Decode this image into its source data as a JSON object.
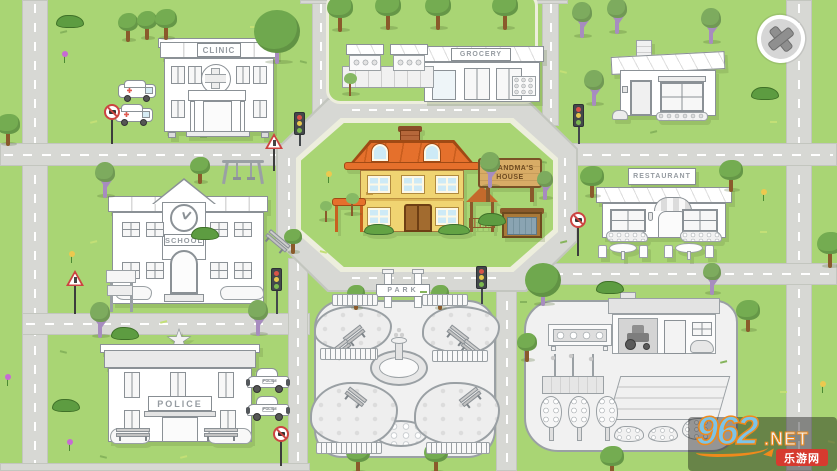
{
  "labels": {
    "clinic": "CLINIC",
    "grocery": "GROCERY",
    "school": "SCHOOL",
    "police": "POLICE",
    "park": "PARK",
    "restaurant": "RESTAURANT",
    "grandma1": "GRANDMA'S",
    "grandma2": "HOUSE",
    "police_car_text": "POLICE"
  },
  "watermark": {
    "site": "962",
    "net": ".NET",
    "cn": "乐游网"
  },
  "palette": {
    "grass": "#a9d574",
    "road": "#d7d8d4",
    "sidewalk": "#edeedd",
    "outline_gray": "#8b9196",
    "roof_orange": "#e5702c",
    "wall_yellow": "#f0d472",
    "door_brown": "#a26b2f",
    "window_blue": "#cdeaf6",
    "wood_sign": "#d8ac66",
    "tree_green": "#74ac51",
    "trunk_brown": "#8a5a2b",
    "trunk_purple": "#a78cbf",
    "sign_red": "#cc4441",
    "traffic_red": "#d85348",
    "traffic_yellow": "#e6c64d",
    "traffic_green": "#7cb94f",
    "wm_blue": "#7cc4e8",
    "wm_orange": "#ef8a1c",
    "wm_red": "#d63a2f"
  },
  "decorations": {
    "trees": [
      {
        "x": 128,
        "y": 42,
        "v": "g",
        "s": 0.8
      },
      {
        "x": 147,
        "y": 40,
        "v": "g",
        "s": 0.8
      },
      {
        "x": 166,
        "y": 40,
        "v": "g",
        "s": 0.85
      },
      {
        "x": 277,
        "y": 64,
        "v": "gp",
        "s": 1.5
      },
      {
        "x": 8,
        "y": 146,
        "v": "g",
        "s": 0.9
      },
      {
        "x": 340,
        "y": 32,
        "v": "g",
        "s": 1.0
      },
      {
        "x": 388,
        "y": 30,
        "v": "g",
        "s": 1.0
      },
      {
        "x": 438,
        "y": 30,
        "v": "g",
        "s": 1.0
      },
      {
        "x": 505,
        "y": 30,
        "v": "g",
        "s": 1.0
      },
      {
        "x": 350,
        "y": 96,
        "v": "s",
        "s": 1.0
      },
      {
        "x": 582,
        "y": 38,
        "v": "p",
        "s": 1.0
      },
      {
        "x": 617,
        "y": 34,
        "v": "p",
        "s": 1.0
      },
      {
        "x": 711,
        "y": 44,
        "v": "p",
        "s": 1.0
      },
      {
        "x": 594,
        "y": 106,
        "v": "p",
        "s": 1.0
      },
      {
        "x": 592,
        "y": 198,
        "v": "g",
        "s": 0.9
      },
      {
        "x": 731,
        "y": 192,
        "v": "g",
        "s": 0.9
      },
      {
        "x": 830,
        "y": 268,
        "v": "g",
        "s": 1.0
      },
      {
        "x": 352,
        "y": 216,
        "v": "s",
        "s": 1.0
      },
      {
        "x": 326,
        "y": 222,
        "v": "s",
        "s": 0.9
      },
      {
        "x": 490,
        "y": 188,
        "v": "p",
        "s": 1.0
      },
      {
        "x": 545,
        "y": 200,
        "v": "p",
        "s": 0.8
      },
      {
        "x": 105,
        "y": 198,
        "v": "p",
        "s": 1.0
      },
      {
        "x": 200,
        "y": 184,
        "v": "g",
        "s": 0.75
      },
      {
        "x": 293,
        "y": 254,
        "v": "g",
        "s": 0.7
      },
      {
        "x": 100,
        "y": 338,
        "v": "p",
        "s": 1.0
      },
      {
        "x": 258,
        "y": 336,
        "v": "p",
        "s": 1.0
      },
      {
        "x": 543,
        "y": 306,
        "v": "gp",
        "s": 1.2
      },
      {
        "x": 527,
        "y": 362,
        "v": "g",
        "s": 0.8
      },
      {
        "x": 712,
        "y": 295,
        "v": "p",
        "s": 0.9
      },
      {
        "x": 748,
        "y": 332,
        "v": "g",
        "s": 0.9
      },
      {
        "x": 356,
        "y": 310,
        "v": "g",
        "s": 0.7
      },
      {
        "x": 440,
        "y": 310,
        "v": "g",
        "s": 0.7
      },
      {
        "x": 358,
        "y": 474,
        "v": "g",
        "s": 0.9
      },
      {
        "x": 436,
        "y": 474,
        "v": "g",
        "s": 0.9
      },
      {
        "x": 612,
        "y": 478,
        "v": "g",
        "s": 0.9
      }
    ],
    "bushes": [
      {
        "x": 70,
        "y": 22
      },
      {
        "x": 765,
        "y": 94
      },
      {
        "x": 125,
        "y": 334
      },
      {
        "x": 66,
        "y": 406
      },
      {
        "x": 492,
        "y": 220
      },
      {
        "x": 205,
        "y": 234
      },
      {
        "x": 610,
        "y": 288
      }
    ],
    "flowers": [
      {
        "x": 64,
        "y": 62,
        "c": "purple"
      },
      {
        "x": 7,
        "y": 385,
        "c": "purple"
      },
      {
        "x": 69,
        "y": 450,
        "c": "purple"
      },
      {
        "x": 328,
        "y": 182,
        "c": "yellow"
      },
      {
        "x": 763,
        "y": 200,
        "c": "yellow"
      },
      {
        "x": 71,
        "y": 262,
        "c": "yellow"
      },
      {
        "x": 822,
        "y": 392,
        "c": "yellow"
      }
    ],
    "traffic_lights": [
      {
        "x": 299,
        "y": 112,
        "p": 10
      },
      {
        "x": 578,
        "y": 104,
        "p": 16
      },
      {
        "x": 276,
        "y": 268,
        "p": 22
      },
      {
        "x": 481,
        "y": 266,
        "p": 14
      }
    ],
    "no_parking_signs": [
      {
        "x": 112,
        "y": 104,
        "p": 24
      },
      {
        "x": 578,
        "y": 212,
        "p": 28
      },
      {
        "x": 281,
        "y": 426,
        "p": 24
      }
    ],
    "warning_signs": [
      {
        "x": 75,
        "y": 270,
        "p": 28
      },
      {
        "x": 274,
        "y": 133,
        "p": 22
      }
    ],
    "benches": [
      {
        "x": 116,
        "y": 428,
        "r": 0,
        "w": 34
      },
      {
        "x": 204,
        "y": 428,
        "r": 0,
        "w": 34
      },
      {
        "x": 264,
        "y": 236,
        "r": 40,
        "w": 26
      },
      {
        "x": 344,
        "y": 330,
        "r": -38,
        "w": 22
      },
      {
        "x": 330,
        "y": 344,
        "r": -38,
        "w": 22
      },
      {
        "x": 446,
        "y": 330,
        "r": 38,
        "w": 22
      },
      {
        "x": 460,
        "y": 344,
        "r": 38,
        "w": 22
      },
      {
        "x": 344,
        "y": 392,
        "r": 38,
        "w": 22
      },
      {
        "x": 460,
        "y": 392,
        "r": -38,
        "w": 22
      }
    ],
    "fences": [
      {
        "x": 320,
        "y": 348,
        "w": 58
      },
      {
        "x": 432,
        "y": 350,
        "w": 56
      },
      {
        "x": 316,
        "y": 442,
        "w": 66
      },
      {
        "x": 426,
        "y": 442,
        "w": 64
      },
      {
        "x": 332,
        "y": 294,
        "w": 46
      },
      {
        "x": 422,
        "y": 294,
        "w": 46
      }
    ],
    "clusters": [
      {
        "x": 314,
        "y": 306,
        "w": 78,
        "h": 46
      },
      {
        "x": 422,
        "y": 306,
        "w": 78,
        "h": 48
      },
      {
        "x": 310,
        "y": 382,
        "w": 88,
        "h": 64
      },
      {
        "x": 414,
        "y": 382,
        "w": 86,
        "h": 64
      }
    ],
    "tufts": [
      [
        60,
        30
      ],
      [
        250,
        25
      ],
      [
        300,
        60
      ],
      [
        90,
        120
      ],
      [
        200,
        135
      ],
      [
        560,
        70
      ],
      [
        650,
        130
      ],
      [
        770,
        120
      ],
      [
        540,
        160
      ],
      [
        90,
        240
      ],
      [
        250,
        210
      ],
      [
        320,
        250
      ],
      [
        560,
        240
      ],
      [
        760,
        230
      ],
      [
        60,
        350
      ],
      [
        160,
        320
      ],
      [
        420,
        290
      ],
      [
        600,
        290
      ],
      [
        720,
        360
      ],
      [
        780,
        390
      ],
      [
        100,
        455
      ],
      [
        180,
        455
      ],
      [
        520,
        300
      ],
      [
        828,
        440
      ]
    ]
  }
}
